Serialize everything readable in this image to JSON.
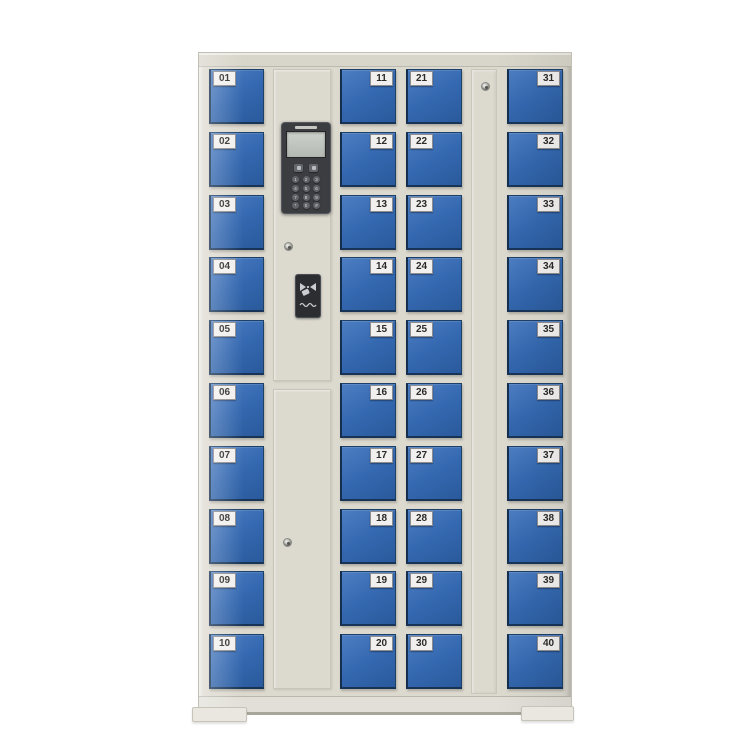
{
  "scene": {
    "type": "product-photo",
    "subject": "40-door electronic smart locker cabinet",
    "background_color": "#ffffff"
  },
  "palette": {
    "cabinet_body": "#dcd9cf",
    "door_blue": "#3468b0",
    "door_edge": "#1d4066",
    "control_panel_dark": "#3b3d41",
    "lcd_screen": "#c3c9c2",
    "number_chip": "#f1f0ee",
    "number_text": "#2a2a2a"
  },
  "cabinet": {
    "door_count_total": 40,
    "columns": [
      {
        "name": "door-column-1",
        "type": "doors",
        "label_side": "left",
        "doors": [
          "01",
          "02",
          "03",
          "04",
          "05",
          "06",
          "07",
          "08",
          "09",
          "10"
        ]
      },
      {
        "name": "control-column",
        "type": "control-panel"
      },
      {
        "name": "door-column-2",
        "type": "doors",
        "label_side": "right",
        "doors": [
          "11",
          "12",
          "13",
          "14",
          "15",
          "16",
          "17",
          "18",
          "19",
          "20"
        ]
      },
      {
        "name": "door-column-3",
        "type": "doors",
        "label_side": "left",
        "doors": [
          "21",
          "22",
          "23",
          "24",
          "25",
          "26",
          "27",
          "28",
          "29",
          "30"
        ]
      },
      {
        "name": "lock-column",
        "type": "lock-door"
      },
      {
        "name": "door-column-4",
        "type": "doors",
        "label_side": "right",
        "doors": [
          "31",
          "32",
          "33",
          "34",
          "35",
          "36",
          "37",
          "38",
          "39",
          "40"
        ]
      }
    ],
    "control_panel": {
      "display": "lcd-screen",
      "function_key_count": 2,
      "keypad_keys": [
        "1",
        "2",
        "3",
        "4",
        "5",
        "6",
        "7",
        "8",
        "9",
        "*",
        "0",
        "#"
      ],
      "card_reader": "rfid-card-swipe-area",
      "keyhole_count": 2
    },
    "lock_column": {
      "keyhole_count": 1
    }
  }
}
